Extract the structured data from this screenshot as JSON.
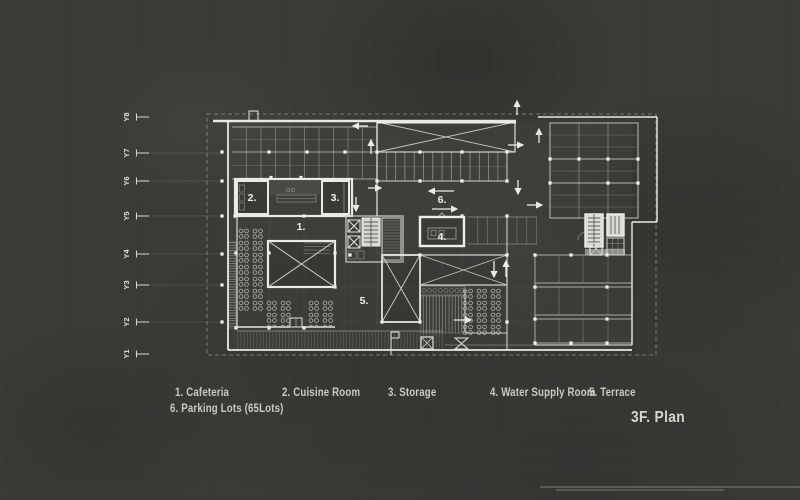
{
  "title": {
    "plan_label": "3F. Plan"
  },
  "legend": {
    "row1": [
      {
        "label": "1. Cafeteria"
      },
      {
        "label": "2. Cuisine Room"
      },
      {
        "label": "3. Storage"
      },
      {
        "label": "4. Water Supply Room"
      },
      {
        "label": "5. Terrace"
      }
    ],
    "row2": [
      {
        "label": "6. Parking Lots (65Lots)"
      }
    ]
  },
  "axis": {
    "labels": [
      "Y8",
      "Y7",
      "Y6",
      "Y5",
      "Y4",
      "Y3",
      "Y2",
      "Y1"
    ]
  },
  "plan": {
    "room_labels": {
      "cafeteria": "1.",
      "cuisine_room": "2.",
      "storage": "3.",
      "water_supply": "4.",
      "terrace": "5.",
      "parking": "6."
    }
  },
  "colors": {
    "background": "#3b3a37",
    "wall_bright": "#eceae4",
    "line_medium": "#a9a8a1",
    "text": "#cbc9c2"
  }
}
